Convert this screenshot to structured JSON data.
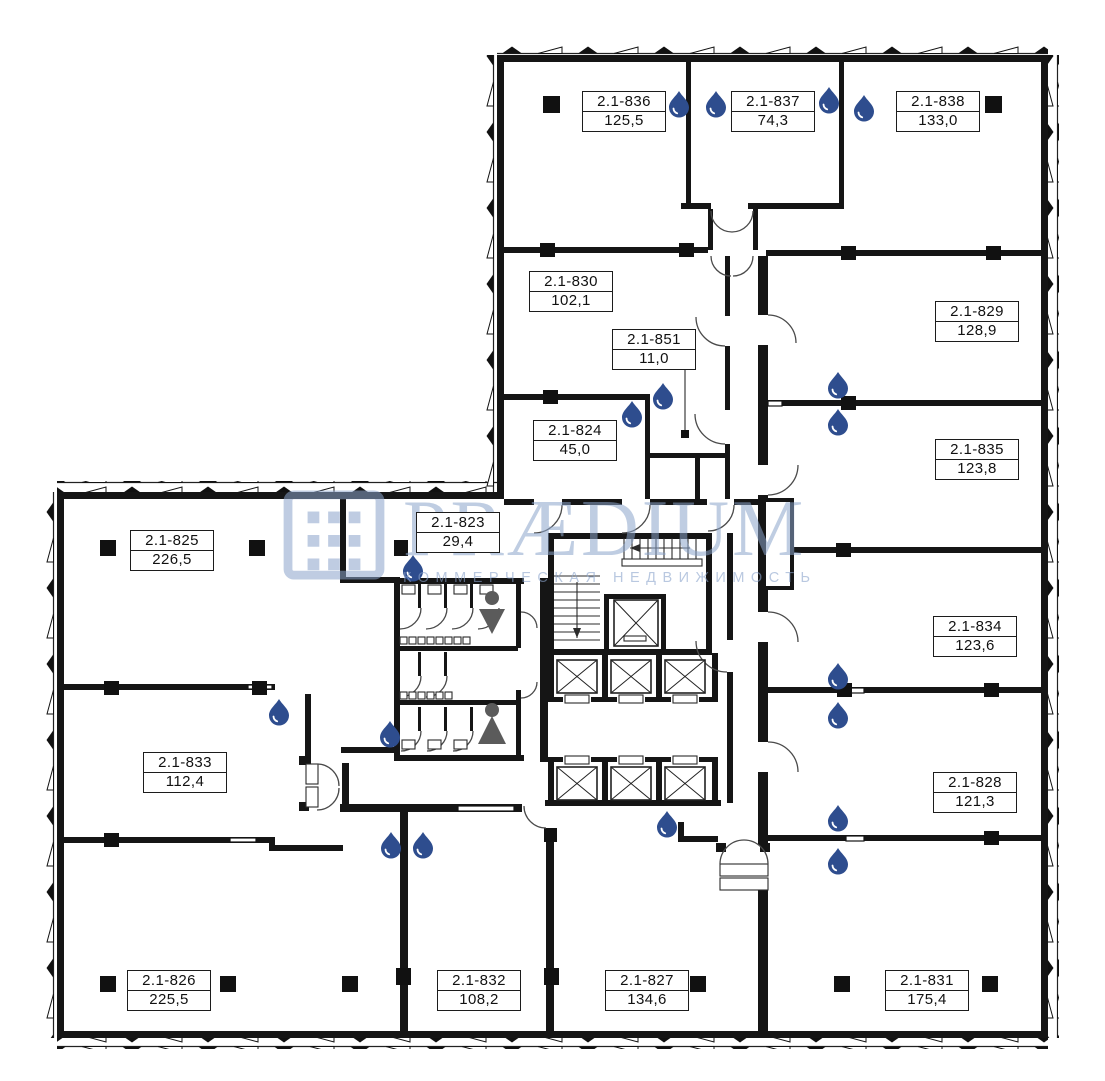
{
  "plan": {
    "rooms": [
      {
        "id": "2.1-836",
        "area": "125,5"
      },
      {
        "id": "2.1-837",
        "area": "74,3"
      },
      {
        "id": "2.1-838",
        "area": "133,0"
      },
      {
        "id": "2.1-830",
        "area": "102,1"
      },
      {
        "id": "2.1-851",
        "area": "11,0"
      },
      {
        "id": "2.1-824",
        "area": "45,0"
      },
      {
        "id": "2.1-829",
        "area": "128,9"
      },
      {
        "id": "2.1-835",
        "area": "123,8"
      },
      {
        "id": "2.1-825",
        "area": "226,5"
      },
      {
        "id": "2.1-823",
        "area": "29,4"
      },
      {
        "id": "2.1-834",
        "area": "123,6"
      },
      {
        "id": "2.1-833",
        "area": "112,4"
      },
      {
        "id": "2.1-828",
        "area": "121,3"
      },
      {
        "id": "2.1-826",
        "area": "225,5"
      },
      {
        "id": "2.1-832",
        "area": "108,2"
      },
      {
        "id": "2.1-827",
        "area": "134,6"
      },
      {
        "id": "2.1-831",
        "area": "175,4"
      }
    ]
  },
  "watermark": {
    "brand": "PRÆDIUM",
    "tagline": "КОММЕРЧЕСКАЯ НЕДВИЖИМОСТЬ"
  },
  "colors": {
    "wall": "#151515",
    "water_drop": "#2e4d8e",
    "wc_icon": "#5b5b5b",
    "watermark": "#8ba4cb"
  }
}
